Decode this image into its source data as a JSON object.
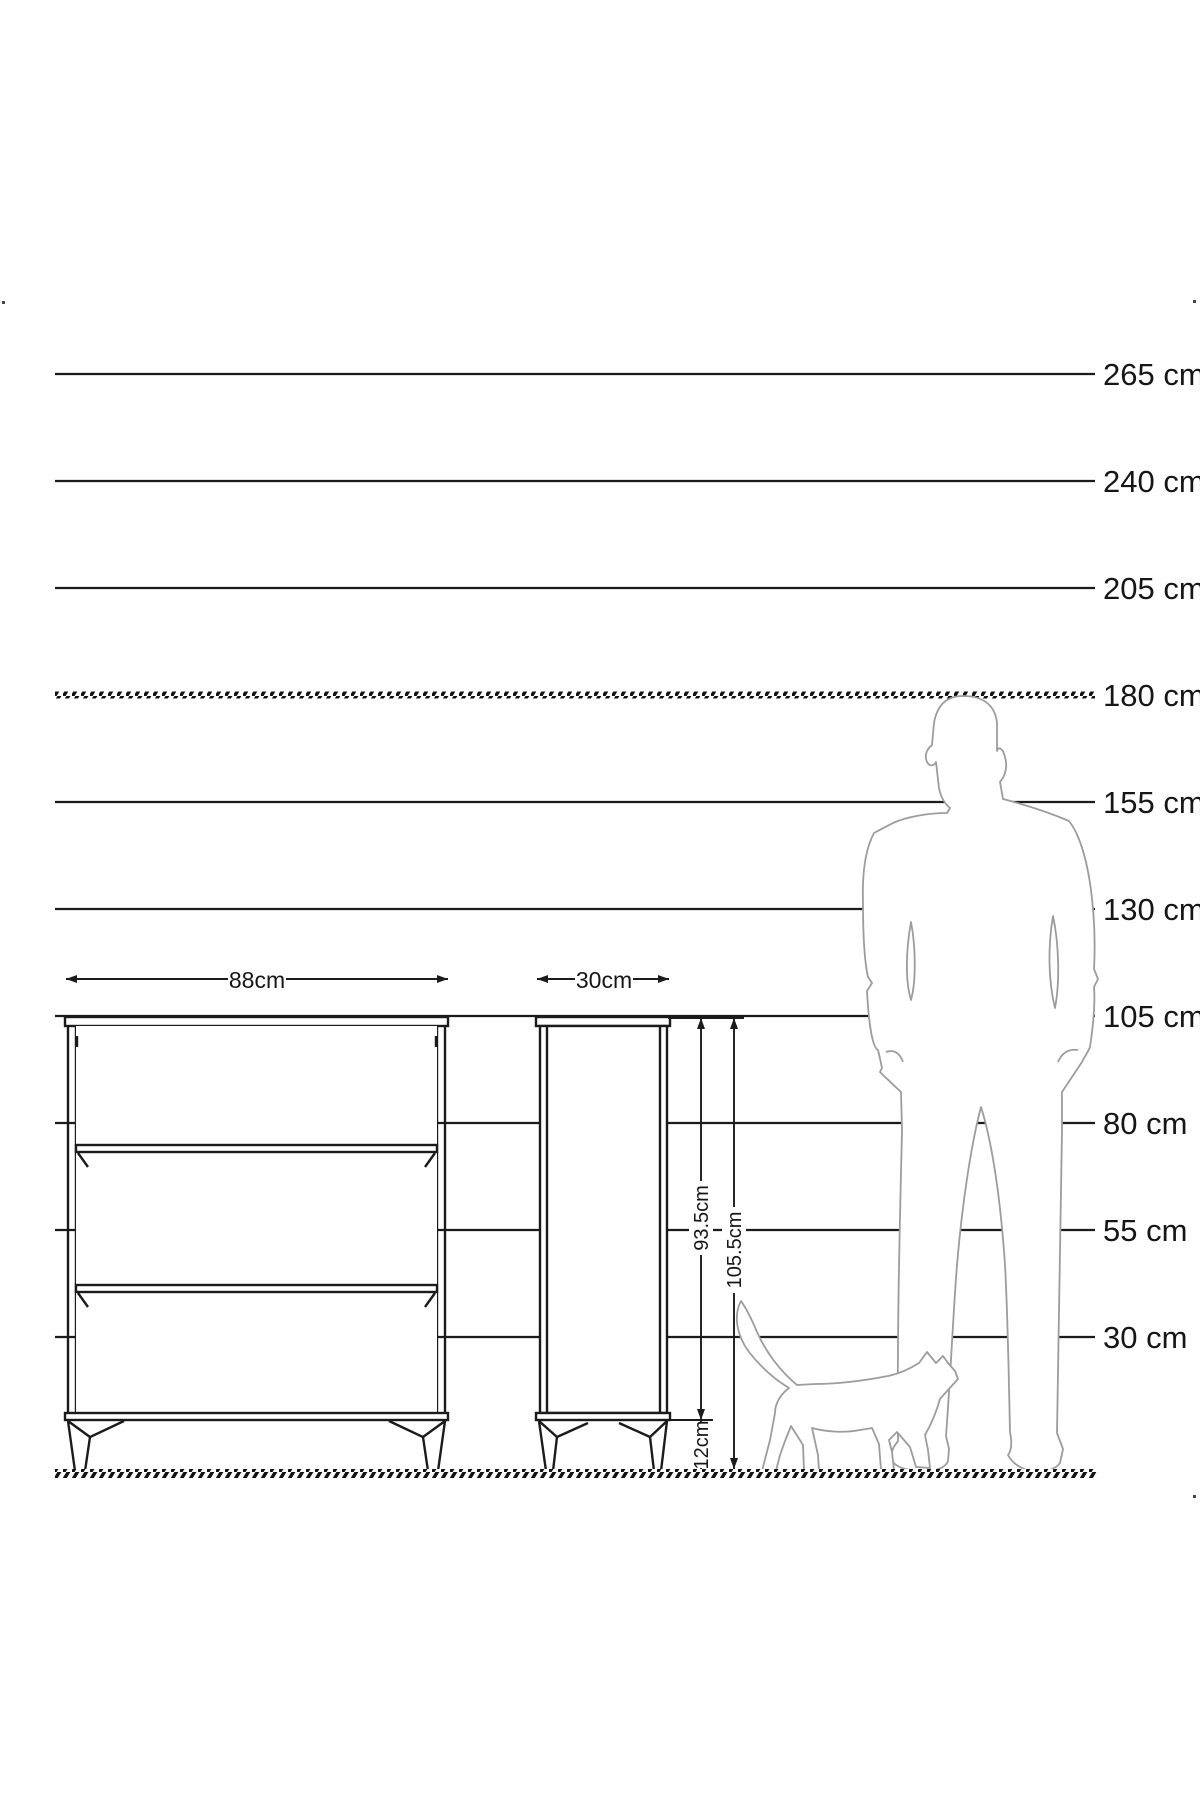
{
  "scale": {
    "unit": "cm",
    "labels": [
      "265 cm",
      "240 cm",
      "205 cm",
      "180 cm",
      "155 cm",
      "130 cm",
      "105 cm",
      "80 cm",
      "55 cm",
      "30 cm"
    ],
    "hatched_index": 3
  },
  "dims": {
    "front_width": "88cm",
    "side_depth": "30cm",
    "body_height": "93.5cm",
    "total_height": "105.5cm",
    "leg_height": "12cm"
  },
  "colors": {
    "line": "#1b1b1b",
    "silhouette": "#9c9c9c",
    "hatch": "#111111"
  }
}
